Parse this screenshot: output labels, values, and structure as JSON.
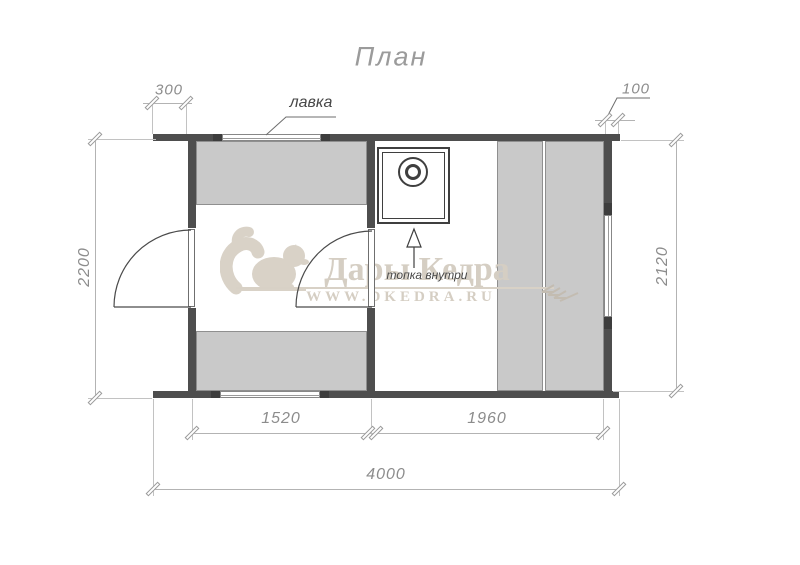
{
  "title": "План",
  "labels": {
    "bench": "лавка",
    "stove_note": "топка внутри"
  },
  "dimensions": {
    "top_left_overhang": "300",
    "top_right_overhang": "100",
    "left_height": "2200",
    "right_height": "2120",
    "bottom_left_room": "1520",
    "bottom_right_room": "1960",
    "total_width": "4000"
  },
  "watermark": {
    "brand": "Дары Кедра",
    "url": "WWW.DKEDRA.RU"
  },
  "colors": {
    "wall": "#4e4e4e",
    "bench_fill": "#c9c9c9",
    "dimension_text": "#8c8c8c",
    "watermark": "#d5cec3",
    "background": "#ffffff"
  }
}
